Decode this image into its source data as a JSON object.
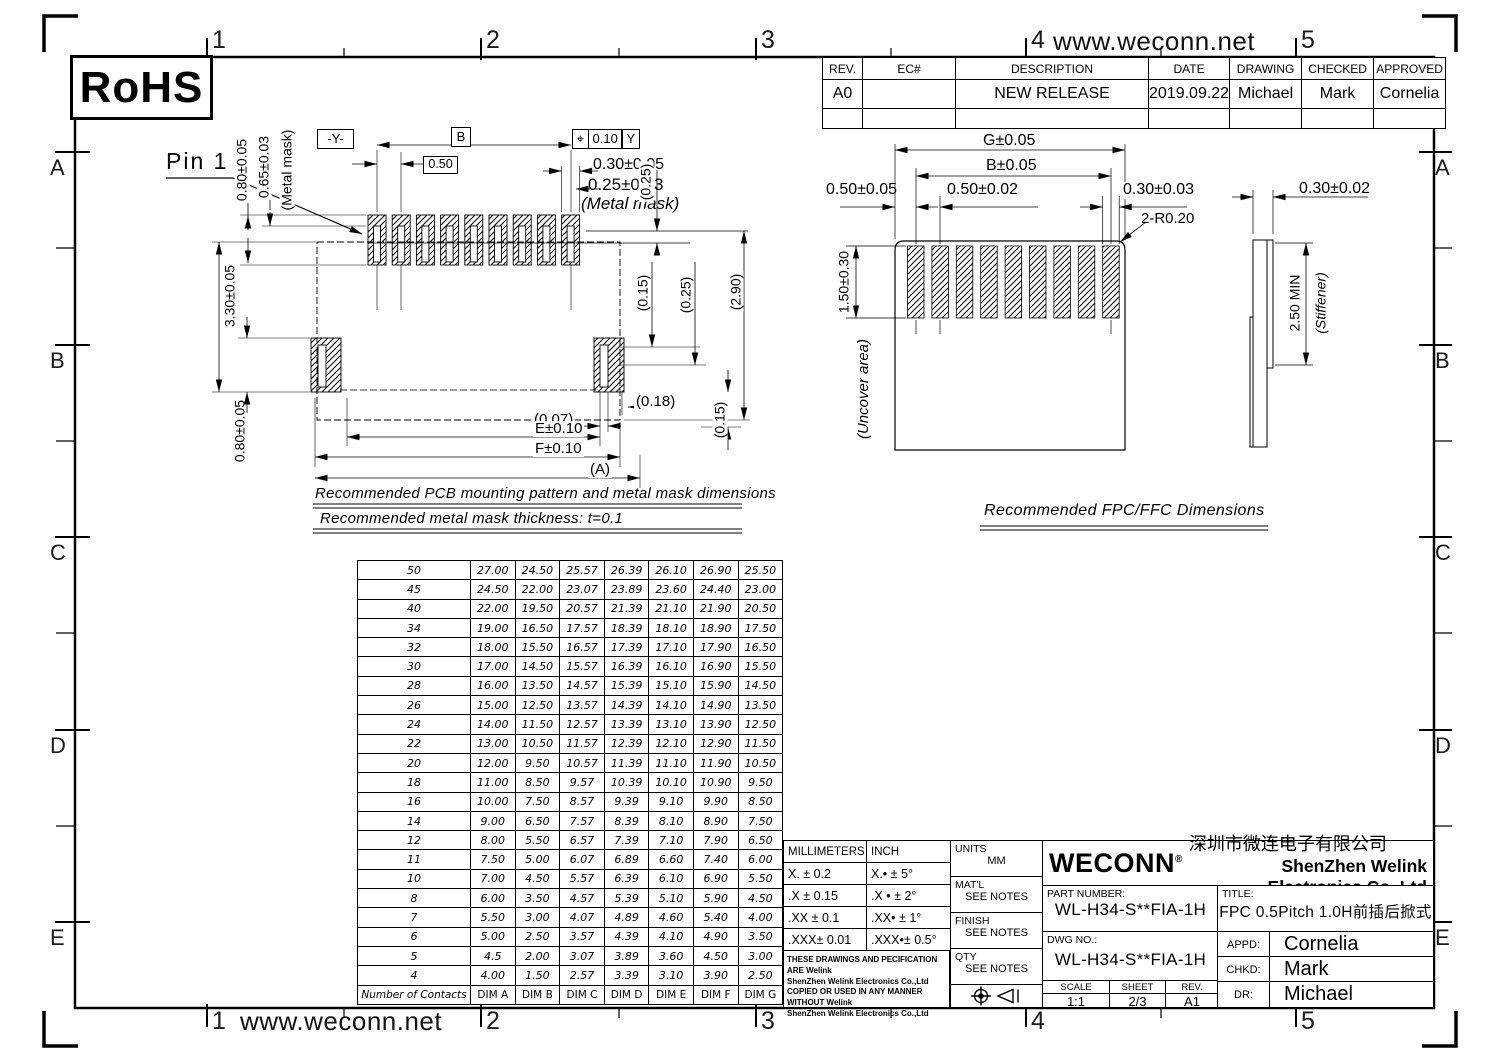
{
  "sheet": {
    "rohs": "RoHS",
    "url_top": "www.weconn.net",
    "url_bottom": "www.weconn.net"
  },
  "zones": {
    "numbers": [
      "1",
      "2",
      "3",
      "4",
      "5"
    ],
    "letters": [
      "A",
      "B",
      "C",
      "D",
      "E"
    ]
  },
  "revision_table": {
    "headers": [
      "REV.",
      "EC#",
      "DESCRIPTION",
      "DATE",
      "DRAWING",
      "CHECKED",
      "APPROVED"
    ],
    "rows": [
      [
        "A0",
        "",
        "NEW RELEASE",
        "2019.09.22",
        "Michael",
        "Mark",
        "Cornelia"
      ],
      [
        "",
        "",
        "",
        "",
        "",
        "",
        ""
      ]
    ]
  },
  "pcb": {
    "pin1": "Pin 1",
    "datum_y": "-Y-",
    "dim_b": "B",
    "pitch": "0.50",
    "fcf_symbol": "⌖",
    "fcf_tol": "0.10",
    "fcf_datum": "Y",
    "pad_width": "0.30±0.05",
    "mask_width": "0.25±0.03",
    "mask_note": "(Metal mask)",
    "ref_025_top": "(0.25)",
    "pad_len": "0.80±0.05",
    "mask_len": "0.65±0.03",
    "mask_note2": "(Metal mask)",
    "body_len": "3.30±0.05",
    "anchor_len": "0.80±0.05",
    "ref_015": "(0.15)",
    "ref_025": "(0.25)",
    "ref_290": "(2.90)",
    "ref_018": "(0.18)",
    "ref_007": "(0.07)",
    "ref_015b": "(0.15)",
    "dim_e": "E±0.10",
    "dim_f": "F±0.10",
    "dim_a": "(A)",
    "caption1": "Recommended PCB mounting pattern and metal mask dimensions",
    "caption2": "Recommended metal mask thickness:  t=0.1"
  },
  "fpc": {
    "dim_g": "G±0.05",
    "dim_b": "B±0.05",
    "edge": "0.50±0.05",
    "pitch": "0.50±0.02",
    "finger_w": "0.30±0.03",
    "radius": "2-R0.20",
    "finger_len": "1.50±0.30",
    "uncover": "(Uncover area)",
    "caption": "Recommended FPC/FFC Dimensions"
  },
  "stiffener": {
    "thickness": "0.30±0.02",
    "length": "2.50 MIN",
    "label": "(Stiffener)"
  },
  "dim_table": {
    "header": [
      "Number of Contacts",
      "DIM A",
      "DIM B",
      "DIM C",
      "DIM D",
      "DIM E",
      "DIM F",
      "DIM G"
    ],
    "rows": [
      [
        "50",
        "27.00",
        "24.50",
        "25.57",
        "26.39",
        "26.10",
        "26.90",
        "25.50"
      ],
      [
        "45",
        "24.50",
        "22.00",
        "23.07",
        "23.89",
        "23.60",
        "24.40",
        "23.00"
      ],
      [
        "40",
        "22.00",
        "19.50",
        "20.57",
        "21.39",
        "21.10",
        "21.90",
        "20.50"
      ],
      [
        "34",
        "19.00",
        "16.50",
        "17.57",
        "18.39",
        "18.10",
        "18.90",
        "17.50"
      ],
      [
        "32",
        "18.00",
        "15.50",
        "16.57",
        "17.39",
        "17.10",
        "17.90",
        "16.50"
      ],
      [
        "30",
        "17.00",
        "14.50",
        "15.57",
        "16.39",
        "16.10",
        "16.90",
        "15.50"
      ],
      [
        "28",
        "16.00",
        "13.50",
        "14.57",
        "15.39",
        "15.10",
        "15.90",
        "14.50"
      ],
      [
        "26",
        "15.00",
        "12.50",
        "13.57",
        "14.39",
        "14.10",
        "14.90",
        "13.50"
      ],
      [
        "24",
        "14.00",
        "11.50",
        "12.57",
        "13.39",
        "13.10",
        "13.90",
        "12.50"
      ],
      [
        "22",
        "13.00",
        "10.50",
        "11.57",
        "12.39",
        "12.10",
        "12.90",
        "11.50"
      ],
      [
        "20",
        "12.00",
        "9.50",
        "10.57",
        "11.39",
        "11.10",
        "11.90",
        "10.50"
      ],
      [
        "18",
        "11.00",
        "8.50",
        "9.57",
        "10.39",
        "10.10",
        "10.90",
        "9.50"
      ],
      [
        "16",
        "10.00",
        "7.50",
        "8.57",
        "9.39",
        "9.10",
        "9.90",
        "8.50"
      ],
      [
        "14",
        "9.00",
        "6.50",
        "7.57",
        "8.39",
        "8.10",
        "8.90",
        "7.50"
      ],
      [
        "12",
        "8.00",
        "5.50",
        "6.57",
        "7.39",
        "7.10",
        "7.90",
        "6.50"
      ],
      [
        "11",
        "7.50",
        "5.00",
        "6.07",
        "6.89",
        "6.60",
        "7.40",
        "6.00"
      ],
      [
        "10",
        "7.00",
        "4.50",
        "5.57",
        "6.39",
        "6.10",
        "6.90",
        "5.50"
      ],
      [
        "8",
        "6.00",
        "3.50",
        "4.57",
        "5.39",
        "5.10",
        "5.90",
        "4.50"
      ],
      [
        "7",
        "5.50",
        "3.00",
        "4.07",
        "4.89",
        "4.60",
        "5.40",
        "4.00"
      ],
      [
        "6",
        "5.00",
        "2.50",
        "3.57",
        "4.39",
        "4.10",
        "4.90",
        "3.50"
      ],
      [
        "5",
        "4.5",
        "2.00",
        "3.07",
        "3.89",
        "3.60",
        "4.50",
        "3.00"
      ],
      [
        "4",
        "4.00",
        "1.50",
        "2.57",
        "3.39",
        "3.10",
        "3.90",
        "2.50"
      ]
    ]
  },
  "tolerance_table": {
    "headers": [
      "MILLIMETERS",
      "INCH"
    ],
    "rows": [
      [
        "X.  ± 0.2",
        "X.• ±  5°"
      ],
      [
        ".X  ± 0.15",
        ".X • ± 2°"
      ],
      [
        ".XX ± 0.1",
        ".XX• ± 1°"
      ],
      [
        ".XXX± 0.01",
        ".XXX•± 0.5°"
      ]
    ],
    "notes": "THESE DRAWINGS AND PECIFICATION  ARE Welink\nShenZhen Welink Electronics Co.,Ltd\n COPIED OR USED IN ANY MANNER WITHOUT Welink\nShenZhen Welink Electronics Co.,Ltd"
  },
  "info": {
    "units_label": "UNITS",
    "units": "MM",
    "matl_label": "MAT'L",
    "matl": "SEE NOTES",
    "finish_label": "FINISH",
    "finish": "SEE NOTES",
    "qty_label": "QTY",
    "qty": "SEE NOTES"
  },
  "title_block": {
    "logo": "WECONN",
    "reg": "®",
    "company_cn": "深圳市微连电子有限公司",
    "company_en": "ShenZhen Welink Electronics Co.,Ltd",
    "part_number_label": "PART NUMBER:",
    "part_number": "WL-H34-S**FIA-1H",
    "title_label": "TITLE:",
    "title": "FPC 0.5Pitch 1.0H前插后掀式",
    "dwg_label": "DWG NO.:",
    "dwg_no": "WL-H34-S**FIA-1H",
    "scale_label": "SCALE",
    "scale": "1:1",
    "sheet_label": "SHEET",
    "sheet": "2/3",
    "rev_label": "REV.",
    "rev": "A1",
    "appd_label": "APPD:",
    "appd": "Cornelia",
    "chkd_label": "CHKD:",
    "chkd": "Mark",
    "dr_label": "DR:",
    "dr": "Michael"
  }
}
